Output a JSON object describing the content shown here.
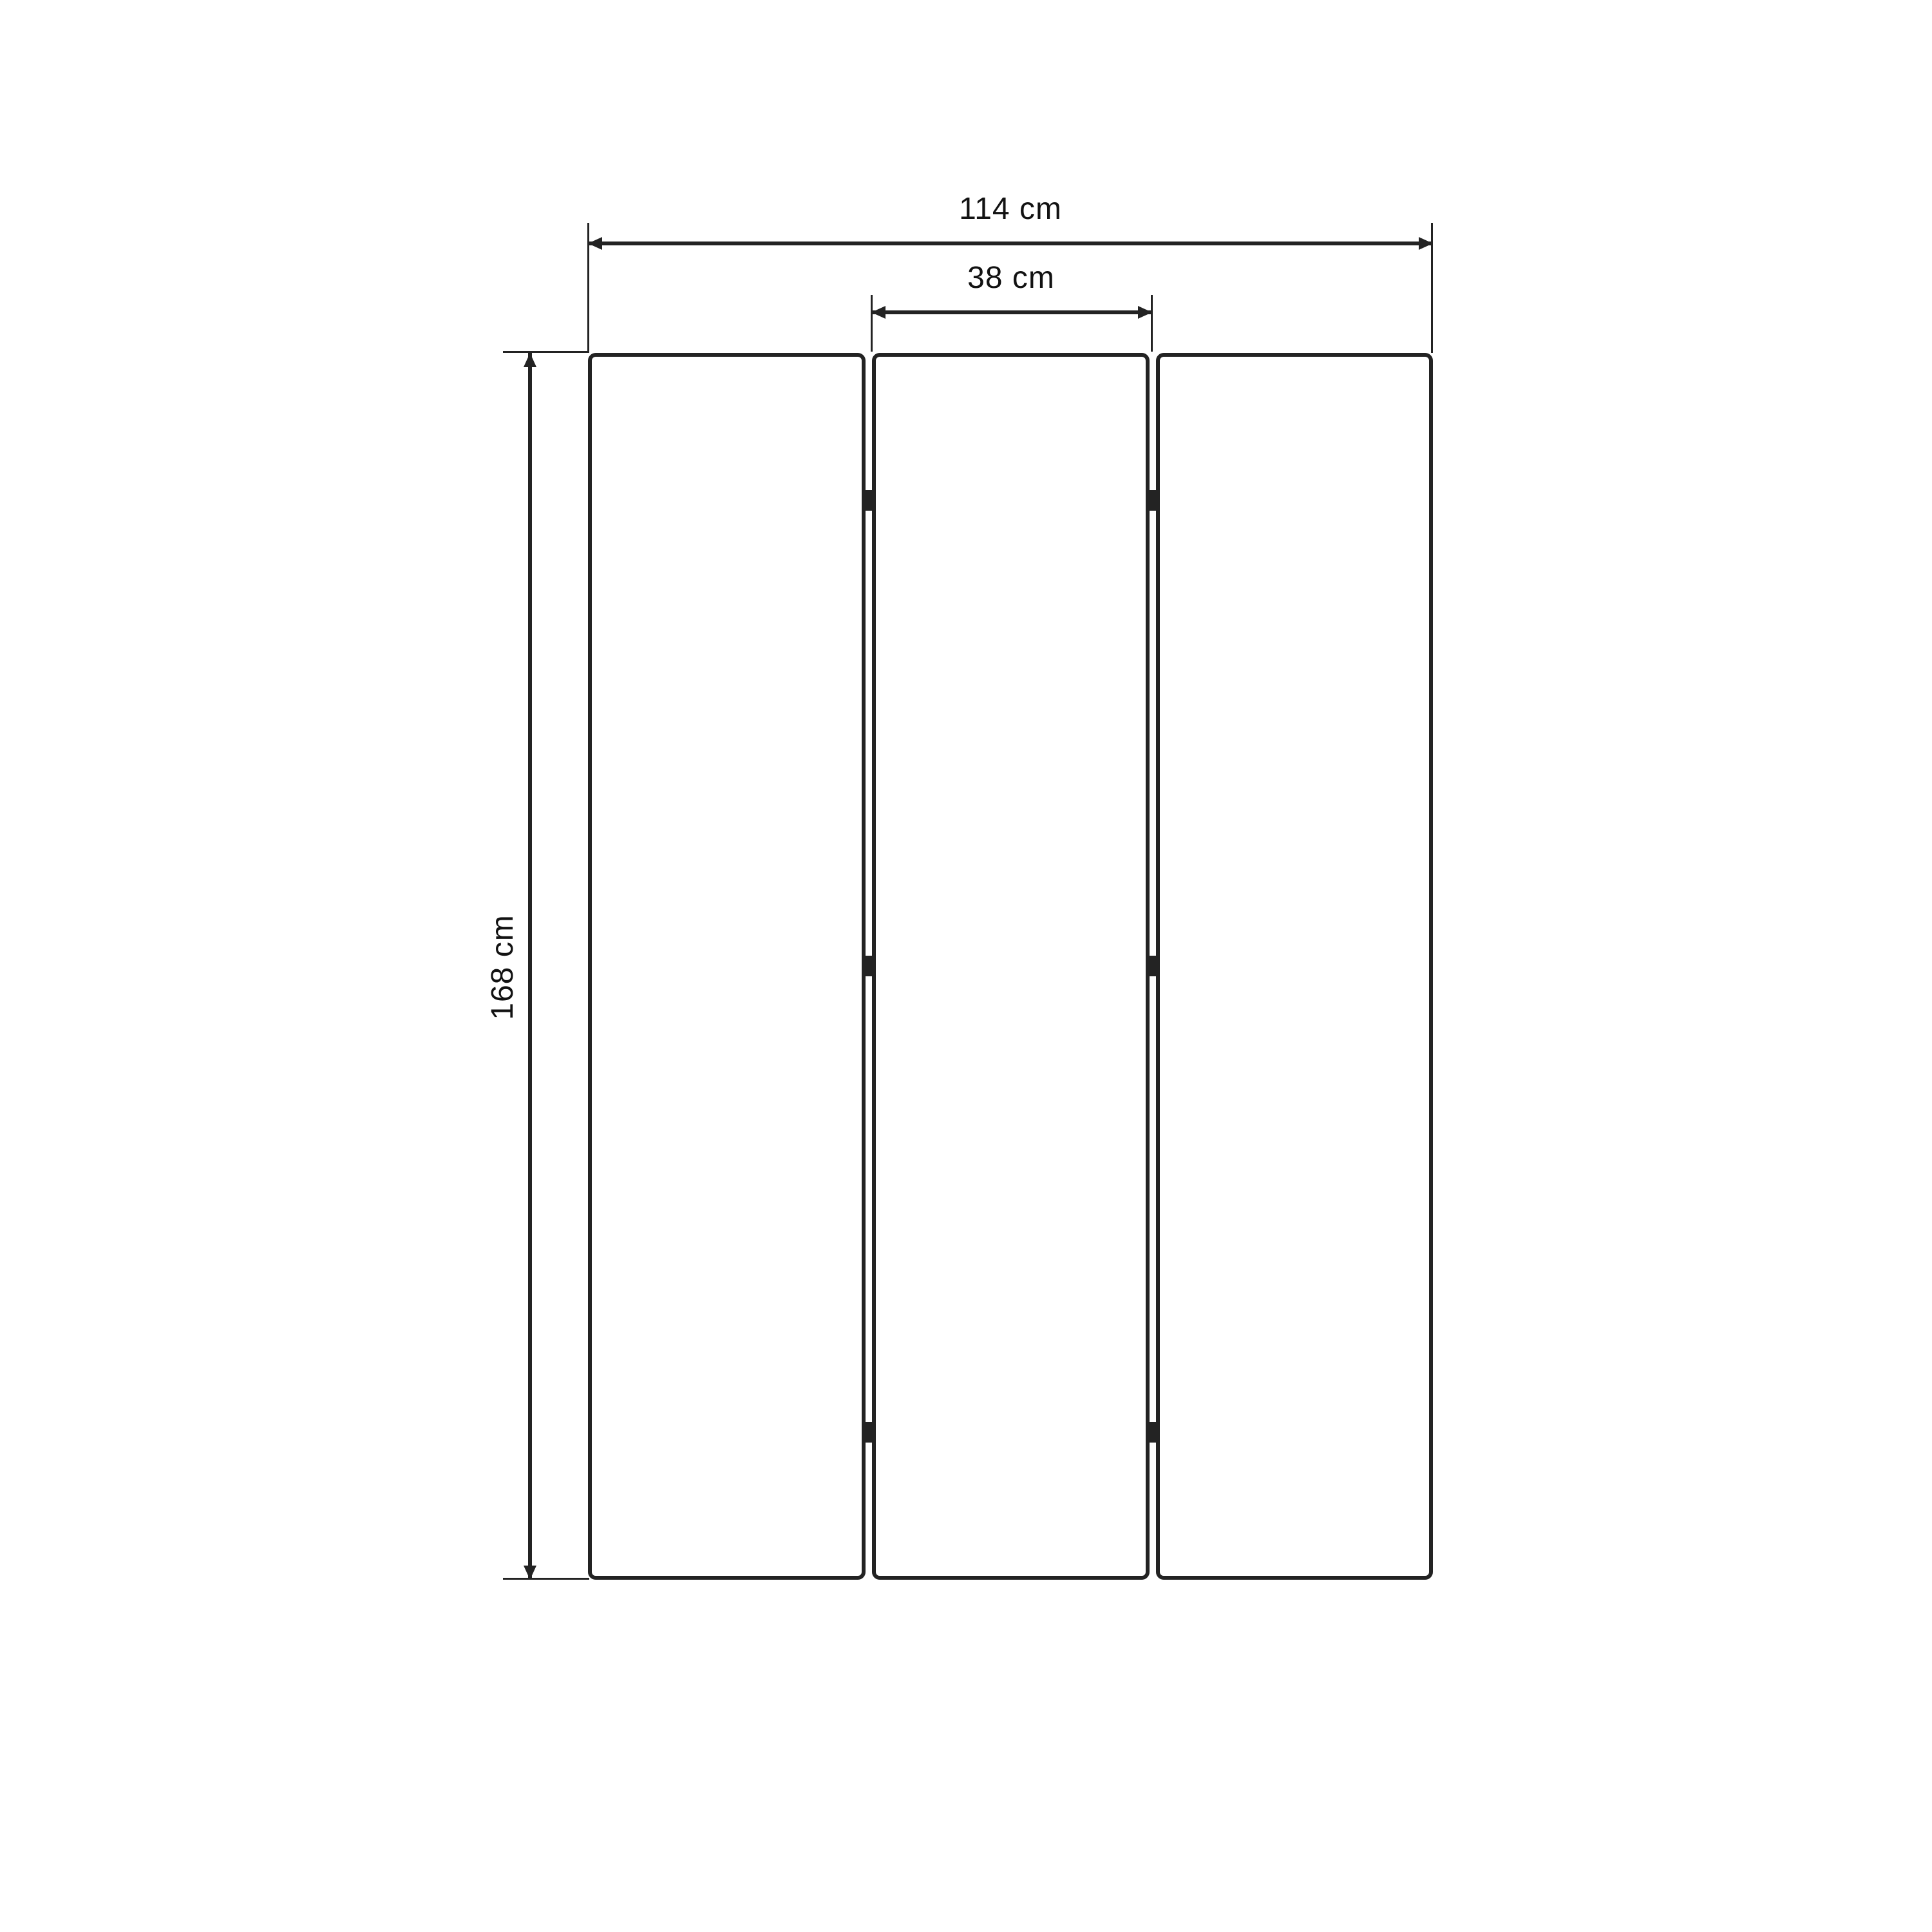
{
  "diagram": {
    "kind": "dimension-drawing",
    "labels": {
      "total_width": "114 cm",
      "panel_width": "38 cm",
      "height": "168 cm"
    },
    "values": {
      "total_width_cm": 114,
      "panel_width_cm": 38,
      "height_cm": 168,
      "unit": "cm"
    },
    "structure": {
      "panel_count": 3,
      "joint_count": 2,
      "hinges_per_joint": 3
    },
    "colors": {
      "ink": "#232323",
      "background": "#ffffff"
    }
  }
}
